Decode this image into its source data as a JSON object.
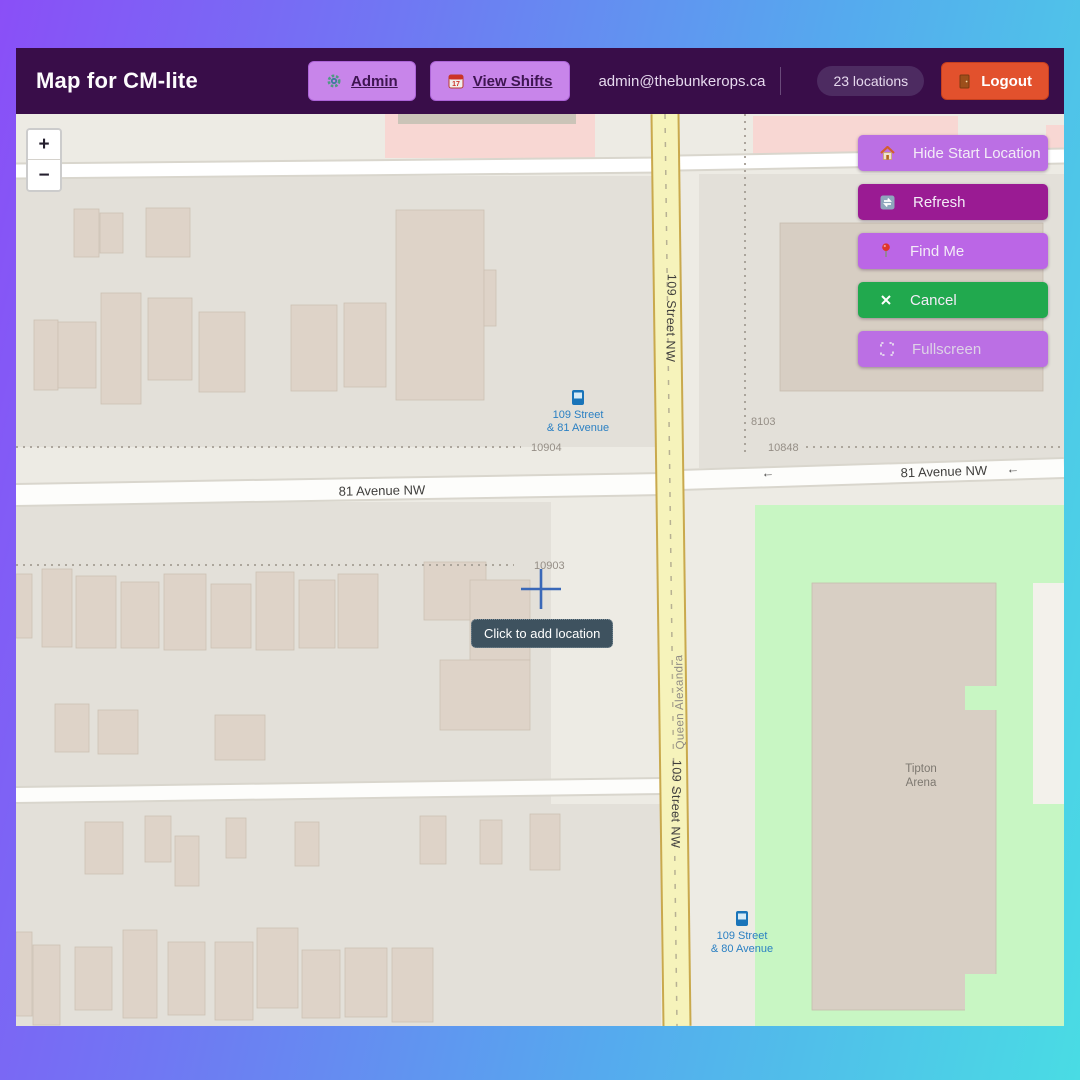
{
  "header": {
    "title": "Map for CM-lite",
    "nav": [
      {
        "label": "Admin",
        "icon": "gear-icon"
      },
      {
        "label": "View Shifts",
        "icon": "calendar-icon"
      }
    ],
    "email": "admin@thebunkerops.ca",
    "locations_badge": "23 locations",
    "logout_label": "Logout",
    "colors": {
      "header_bg": "#390d49",
      "nav_button_bg": "#c885ea",
      "logout_bg": "#e2512d",
      "badge_bg": "#4d2b61"
    }
  },
  "map_controls": {
    "zoom_in": "+",
    "zoom_out": "−"
  },
  "action_buttons": [
    {
      "label": "Hide Start Location",
      "icon": "house-icon",
      "bg": "#bb6fe4"
    },
    {
      "label": "Refresh",
      "icon": "refresh-icon",
      "bg": "#9a1b93"
    },
    {
      "label": "Find Me",
      "icon": "pin-icon",
      "bg": "#bb66e6"
    },
    {
      "label": "Cancel",
      "icon": "x-icon",
      "bg": "#21a94e"
    },
    {
      "label": "Fullscreen",
      "icon": "fullscreen-icon",
      "bg": "#bb6fe4"
    }
  ],
  "tooltip": {
    "text": "Click to add location"
  },
  "map": {
    "streets": {
      "s109": "109 Street NW",
      "ave81": "81 Avenue NW",
      "queen": "Queen Alexandra",
      "oneway_arrow": "←"
    },
    "house_numbers": {
      "n10904": "10904",
      "n10903": "10903",
      "n8103": "8103",
      "n10848": "10848"
    },
    "transit_stops": [
      {
        "line1": "109 Street",
        "line2": "& 81 Avenue"
      },
      {
        "line1": "109 Street",
        "line2": "& 80 Avenue"
      }
    ],
    "poi": {
      "tipton_line1": "Tipton",
      "tipton_line2": "Arena"
    },
    "colors": {
      "road_yellow": "#f6f3bb",
      "park_green": "#c8f6c3",
      "building": "#ded3c8",
      "transit_blue": "#2b80c3",
      "crosshair_blue": "#3a68b8"
    }
  }
}
